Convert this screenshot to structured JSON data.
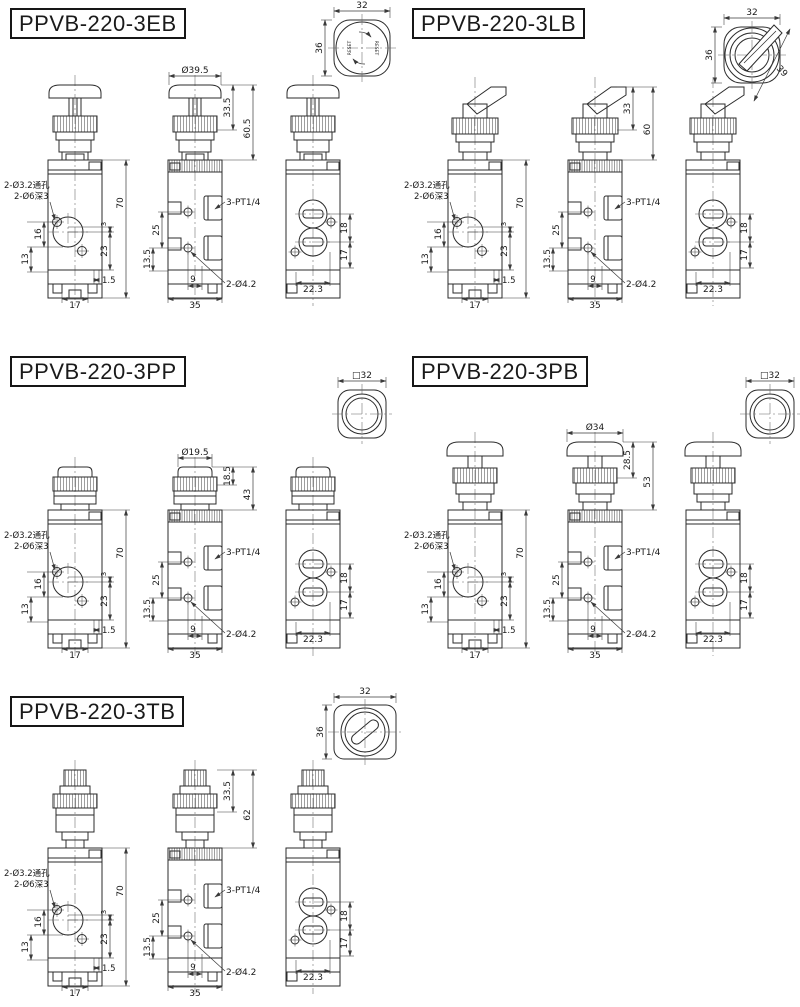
{
  "drawing": {
    "background": "#ffffff",
    "line_color": "#2b2b2b",
    "dim_color": "#3a3a3a",
    "text_color": "#1a1a1a"
  },
  "sections": [
    {
      "id": "ppvb-220-3eb",
      "title": "PPVB-220-3EB",
      "head_type": "mushroom-reset-button",
      "top_view": {
        "style": "rounded-square-reset",
        "dim_width": "32",
        "dim_height": "36",
        "reset_labels": [
          "RESET",
          "RESET"
        ]
      },
      "head_dims": {
        "cap_diameter": "Ø39.5",
        "upper_height": "33.5",
        "total_height": "60.5"
      },
      "front_dims": {
        "hole_note_line1": "2-Ø3.2通孔",
        "hole_note_line2": "2-Ø6深3",
        "overall_height": "70",
        "step": "3",
        "port_center": "23",
        "hole_span_upper": "16",
        "hole_span_lower": "13",
        "foot_offset": "1.5",
        "foot_pitch": "17"
      },
      "mid_dims": {
        "port_thread_note": "3-PT1/4",
        "mount_hole_note": "2-Ø4.2",
        "hole_span_upper": "25",
        "hole_span_lower": "13.5",
        "hole_pitch": "9",
        "body_width": "35"
      },
      "side_dims": {
        "port_span_upper": "18",
        "port_span_lower": "17",
        "body_depth": "22.3"
      }
    },
    {
      "id": "ppvb-220-3lb",
      "title": "PPVB-220-3LB",
      "head_type": "selector-lever",
      "top_view": {
        "style": "rounded-square-lever",
        "dim_width": "32",
        "dim_height": "36",
        "dim_diagonal": "39"
      },
      "head_dims": {
        "upper_height": "33",
        "total_height": "60"
      },
      "front_dims": {
        "hole_note_line1": "2-Ø3.2通孔",
        "hole_note_line2": "2-Ø6深3",
        "overall_height": "70",
        "step": "3",
        "port_center": "23",
        "hole_span_upper": "16",
        "hole_span_lower": "13",
        "foot_offset": "1.5",
        "foot_pitch": "17"
      },
      "mid_dims": {
        "port_thread_note": "3-PT1/4",
        "mount_hole_note": "2-Ø4.2",
        "hole_span_upper": "25",
        "hole_span_lower": "13.5",
        "hole_pitch": "9",
        "body_width": "35"
      },
      "side_dims": {
        "port_span_upper": "18",
        "port_span_lower": "17",
        "body_depth": "22.3"
      }
    },
    {
      "id": "ppvb-220-3pp",
      "title": "PPVB-220-3PP",
      "head_type": "flush-push-button",
      "top_view": {
        "style": "rounded-square-circles",
        "square_note": "□32"
      },
      "head_dims": {
        "cap_diameter": "Ø19.5",
        "upper_height": "18.5",
        "total_height": "43"
      },
      "front_dims": {
        "hole_note_line1": "2-Ø3.2通孔",
        "hole_note_line2": "2-Ø6深3",
        "overall_height": "70",
        "step": "3",
        "port_center": "23",
        "hole_span_upper": "16",
        "hole_span_lower": "13",
        "foot_offset": "1.5",
        "foot_pitch": "17"
      },
      "mid_dims": {
        "port_thread_note": "3-PT1/4",
        "mount_hole_note": "2-Ø4.2",
        "hole_span_upper": "25",
        "hole_span_lower": "13.5",
        "hole_pitch": "9",
        "body_width": "35"
      },
      "side_dims": {
        "port_span_upper": "18",
        "port_span_lower": "17",
        "body_depth": "22.3"
      }
    },
    {
      "id": "ppvb-220-3pb",
      "title": "PPVB-220-3PB",
      "head_type": "mushroom-push-button",
      "top_view": {
        "style": "rounded-square-circles",
        "square_note": "□32"
      },
      "head_dims": {
        "cap_diameter": "Ø34",
        "upper_height": "28.5",
        "total_height": "53"
      },
      "front_dims": {
        "hole_note_line1": "2-Ø3.2通孔",
        "hole_note_line2": "2-Ø6深3",
        "overall_height": "70",
        "step": "3",
        "port_center": "23",
        "hole_span_upper": "16",
        "hole_span_lower": "13",
        "foot_offset": "1.5",
        "foot_pitch": "17"
      },
      "mid_dims": {
        "port_thread_note": "3-PT1/4",
        "mount_hole_note": "2-Ø4.2",
        "hole_span_upper": "25",
        "hole_span_lower": "13.5",
        "hole_pitch": "9",
        "body_width": "35"
      },
      "side_dims": {
        "port_span_upper": "18",
        "port_span_lower": "17",
        "body_depth": "22.3"
      }
    },
    {
      "id": "ppvb-220-3tb",
      "title": "PPVB-220-3TB",
      "head_type": "key-turn-switch",
      "top_view": {
        "style": "rounded-square-keyswitch",
        "dim_width": "32",
        "dim_height": "36"
      },
      "head_dims": {
        "upper_height": "33.5",
        "total_height": "62"
      },
      "front_dims": {
        "hole_note_line1": "2-Ø3.2通孔",
        "hole_note_line2": "2-Ø6深3",
        "overall_height": "70",
        "step": "3",
        "port_center": "23",
        "hole_span_upper": "16",
        "hole_span_lower": "13",
        "foot_offset": "1.5",
        "foot_pitch": "17"
      },
      "mid_dims": {
        "port_thread_note": "3-PT1/4",
        "mount_hole_note": "2-Ø4.2",
        "hole_span_upper": "25",
        "hole_span_lower": "13.5",
        "hole_pitch": "9",
        "body_width": "35"
      },
      "side_dims": {
        "port_span_upper": "18",
        "port_span_lower": "17",
        "body_depth": "22.3"
      }
    }
  ]
}
